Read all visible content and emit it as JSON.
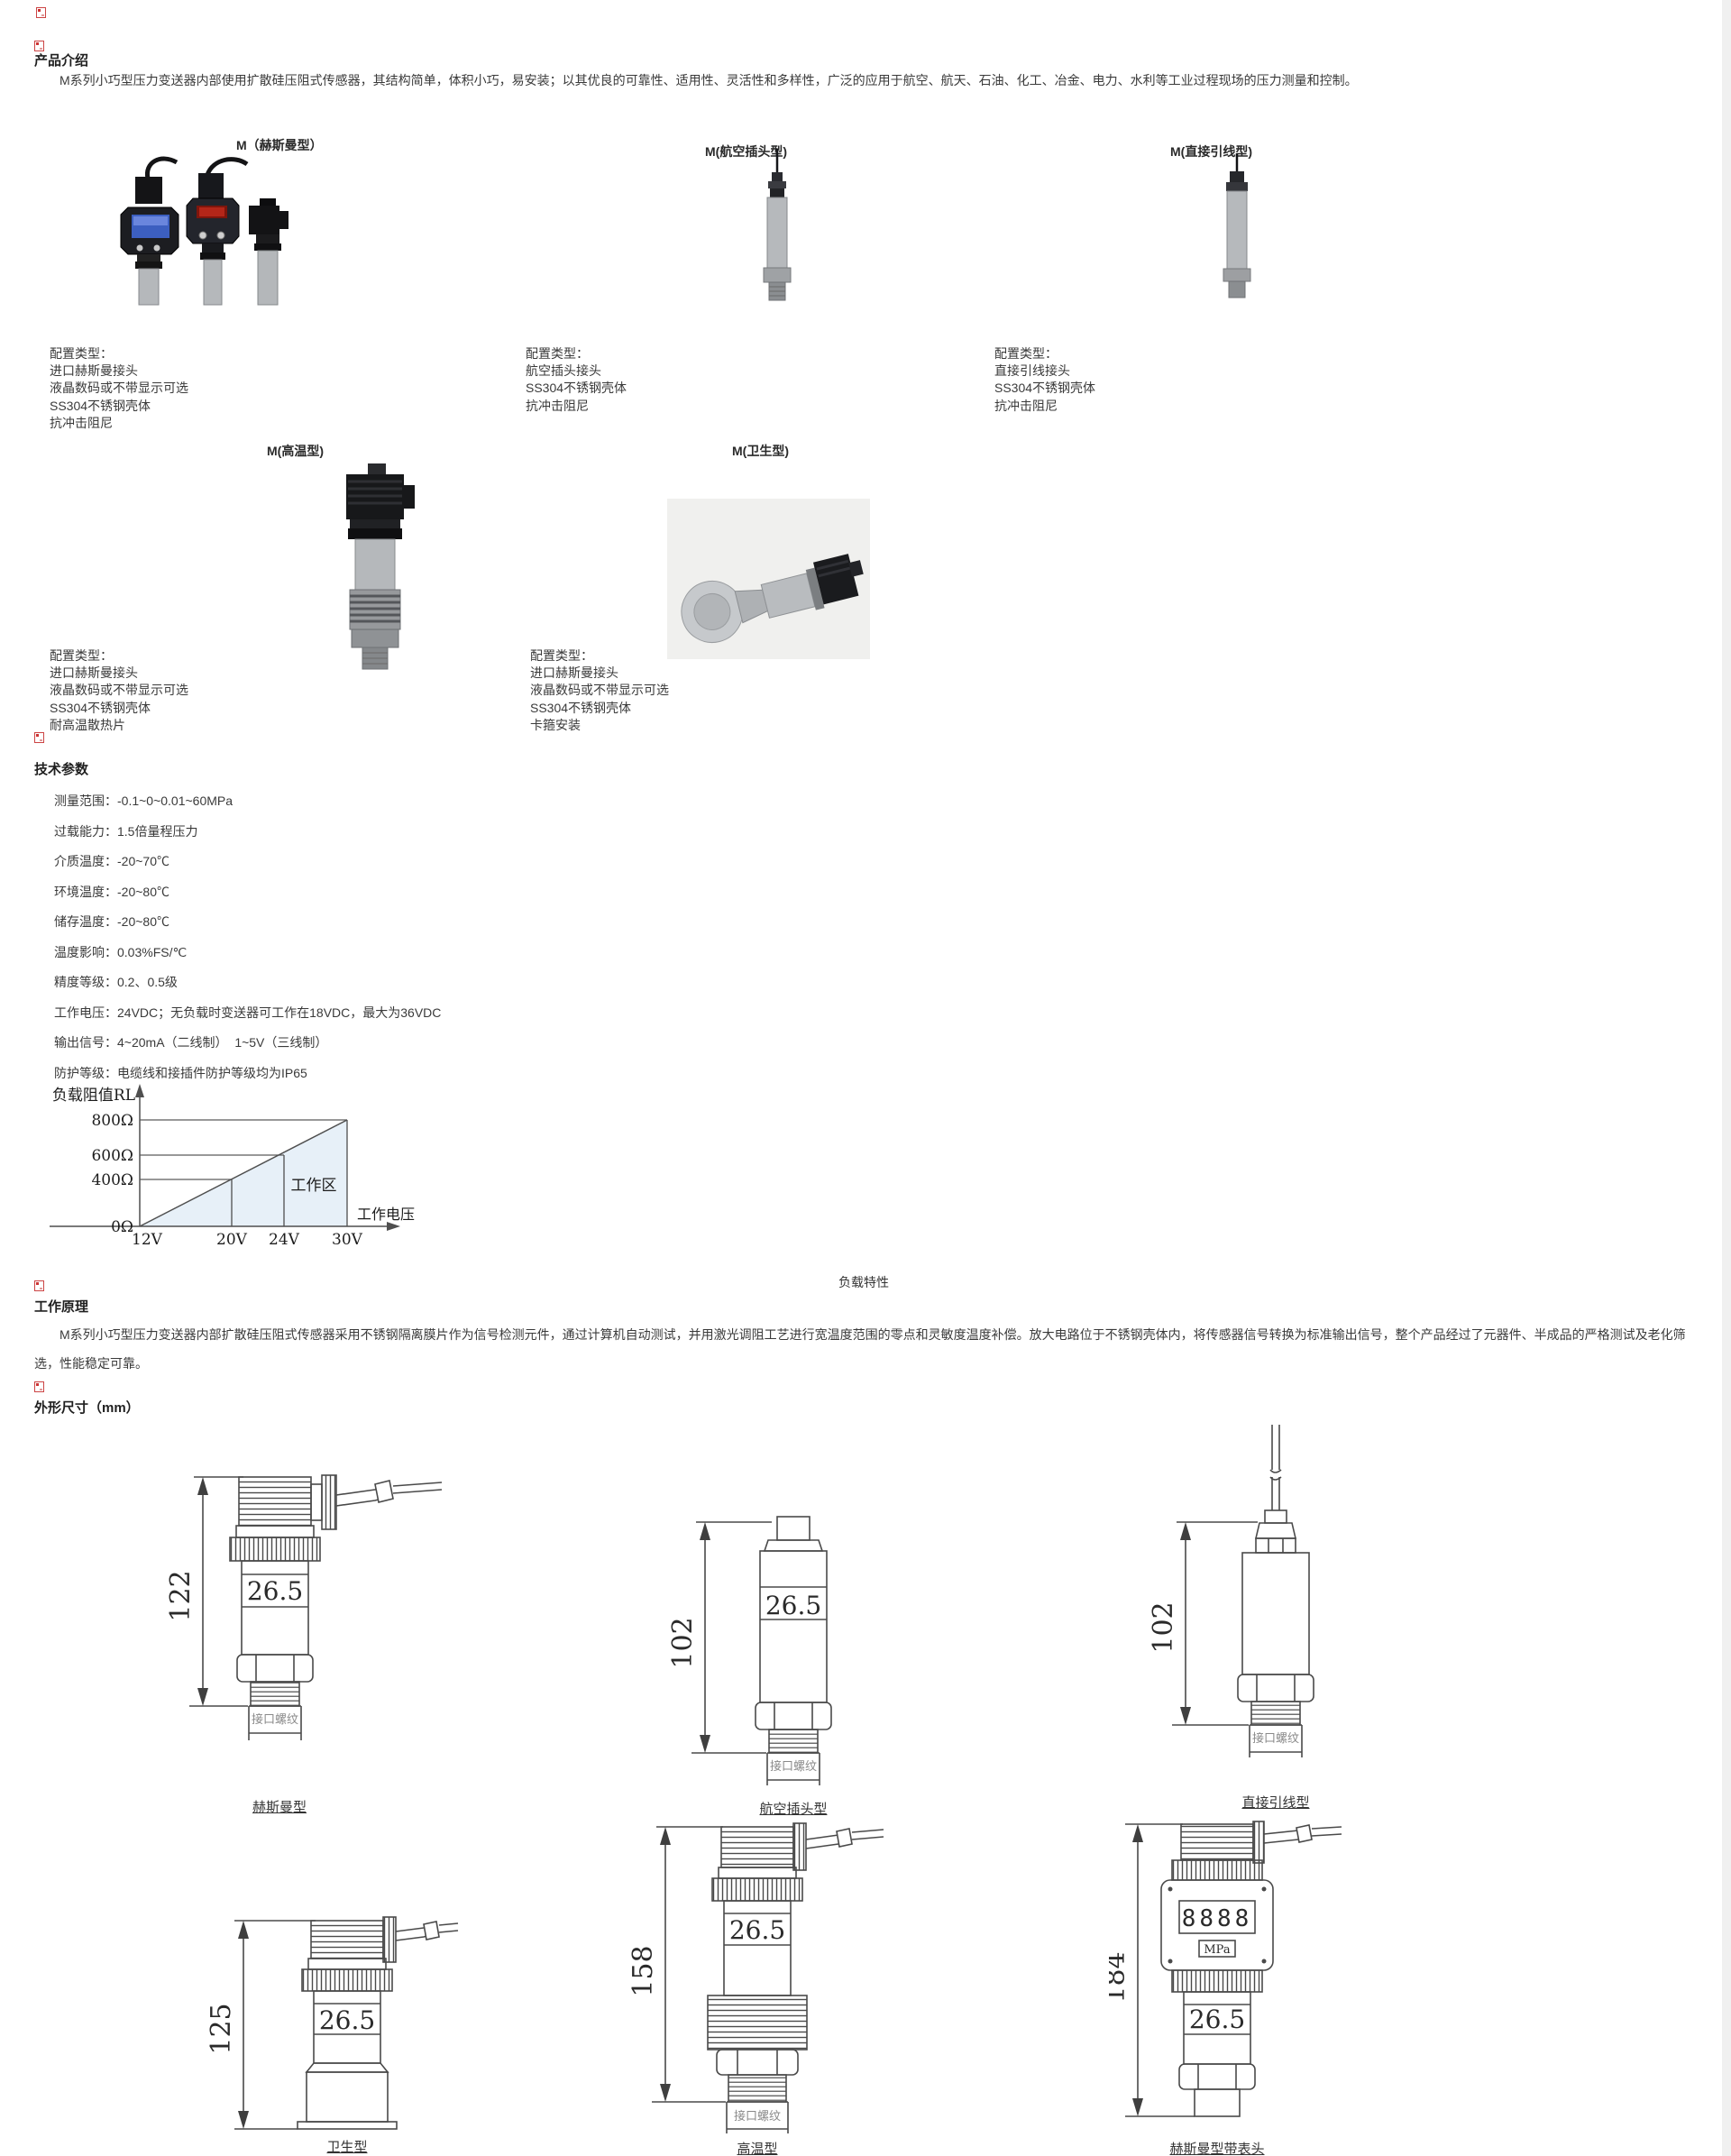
{
  "intro": {
    "heading": "产品介绍",
    "body": "M系列小巧型压力变送器内部使用扩散硅压阻式传感器，其结构简单，体积小巧，易安装；以其优良的可靠性、适用性、灵活性和多样性，广泛的应用于航空、航天、石油、化工、冶金、电力、水利等工业过程现场的压力测量和控制。"
  },
  "products": {
    "row1": [
      {
        "title": "M（赫斯曼型）",
        "config": [
          "配置类型：",
          "进口赫斯曼接头",
          "液晶数码或不带显示可选",
          "SS304不锈钢壳体",
          "抗冲击阻尼"
        ]
      },
      {
        "title": "M(航空插头型)",
        "config": [
          "配置类型：",
          "航空插头接头",
          "SS304不锈钢壳体",
          "抗冲击阻尼"
        ]
      },
      {
        "title": "M(直接引线型)",
        "config": [
          "配置类型：",
          "直接引线接头",
          "SS304不锈钢壳体",
          "抗冲击阻尼"
        ]
      }
    ],
    "row2": [
      {
        "title": "M(高温型)",
        "config": [
          "配置类型：",
          "进口赫斯曼接头",
          "液晶数码或不带显示可选",
          "SS304不锈钢壳体",
          "耐高温散热片"
        ]
      },
      {
        "title": "M(卫生型)",
        "config": [
          "配置类型：",
          "进口赫斯曼接头",
          "液晶数码或不带显示可选",
          "SS304不锈钢壳体",
          "卡箍安装"
        ]
      }
    ]
  },
  "tech": {
    "heading": "技术参数",
    "params": [
      "测量范围：-0.1~0~0.01~60MPa",
      "过载能力：1.5倍量程压力",
      "介质温度：-20~70℃",
      "环境温度：-20~80℃",
      "储存温度：-20~80℃",
      "温度影响：0.03%FS/℃",
      "精度等级：0.2、0.5级",
      "工作电压：24VDC；无负载时变送器可工作在18VDC，最大为36VDC",
      "输出信号：4~20mA（二线制）  1~5V（三线制）",
      "防护等级：电缆线和接插件防护等级均为IP65"
    ]
  },
  "chart_data": {
    "type": "line",
    "title": "负载特性",
    "ylabel": "负载阻值RL",
    "xlabel": "工作电压",
    "x_ticks": [
      "12V",
      "20V",
      "24V",
      "30V"
    ],
    "y_ticks": [
      "800Ω",
      "600Ω",
      "400Ω",
      "0Ω"
    ],
    "x_values": [
      12,
      20,
      24,
      30
    ],
    "y_values_ohm": [
      0,
      400,
      600,
      800
    ],
    "line": {
      "x": [
        12,
        30
      ],
      "y": [
        0,
        800
      ]
    },
    "region_label": "工作区",
    "xlim": [
      12,
      32
    ],
    "ylim": [
      0,
      900
    ],
    "grid": false,
    "legend_position": "none"
  },
  "principle": {
    "heading": "工作原理",
    "body": "M系列小巧型压力变送器内部扩散硅压阻式传感器采用不锈钢隔离膜片作为信号检测元件，通过计算机自动测试，并用激光调阻工艺进行宽温度范围的零点和灵敏度温度补偿。放大电路位于不锈钢壳体内，将传感器信号转换为标准输出信号，整个产品经过了元器件、半成品的严格测试及老化筛选，性能稳定可靠。"
  },
  "dims": {
    "heading": "外形尺寸（mm）",
    "drawings": [
      {
        "label": "赫斯曼型",
        "height": "122",
        "width": "26.5",
        "thread": "接口螺纹"
      },
      {
        "label": "航空插头型",
        "height": "102",
        "width": "26.5",
        "thread": "接口螺纹"
      },
      {
        "label": "直接引线型",
        "height": "102",
        "thread": "接口螺纹"
      },
      {
        "label": "卫生型",
        "height": "125",
        "width": "26.5"
      },
      {
        "label": "高温型",
        "height": "158",
        "width": "26.5",
        "thread": "接口螺纹"
      },
      {
        "label": "赫斯曼型带表头",
        "height": "184",
        "width": "26.5",
        "thread": "接口螺纹",
        "display_digits": "8888",
        "display_unit": "MPa"
      }
    ]
  },
  "colors": {
    "accent_red": "#cc3333",
    "drawing_stroke": "#4a4a4a",
    "chart_shade": "#e7f0f8",
    "text": "#3a3a3a"
  }
}
